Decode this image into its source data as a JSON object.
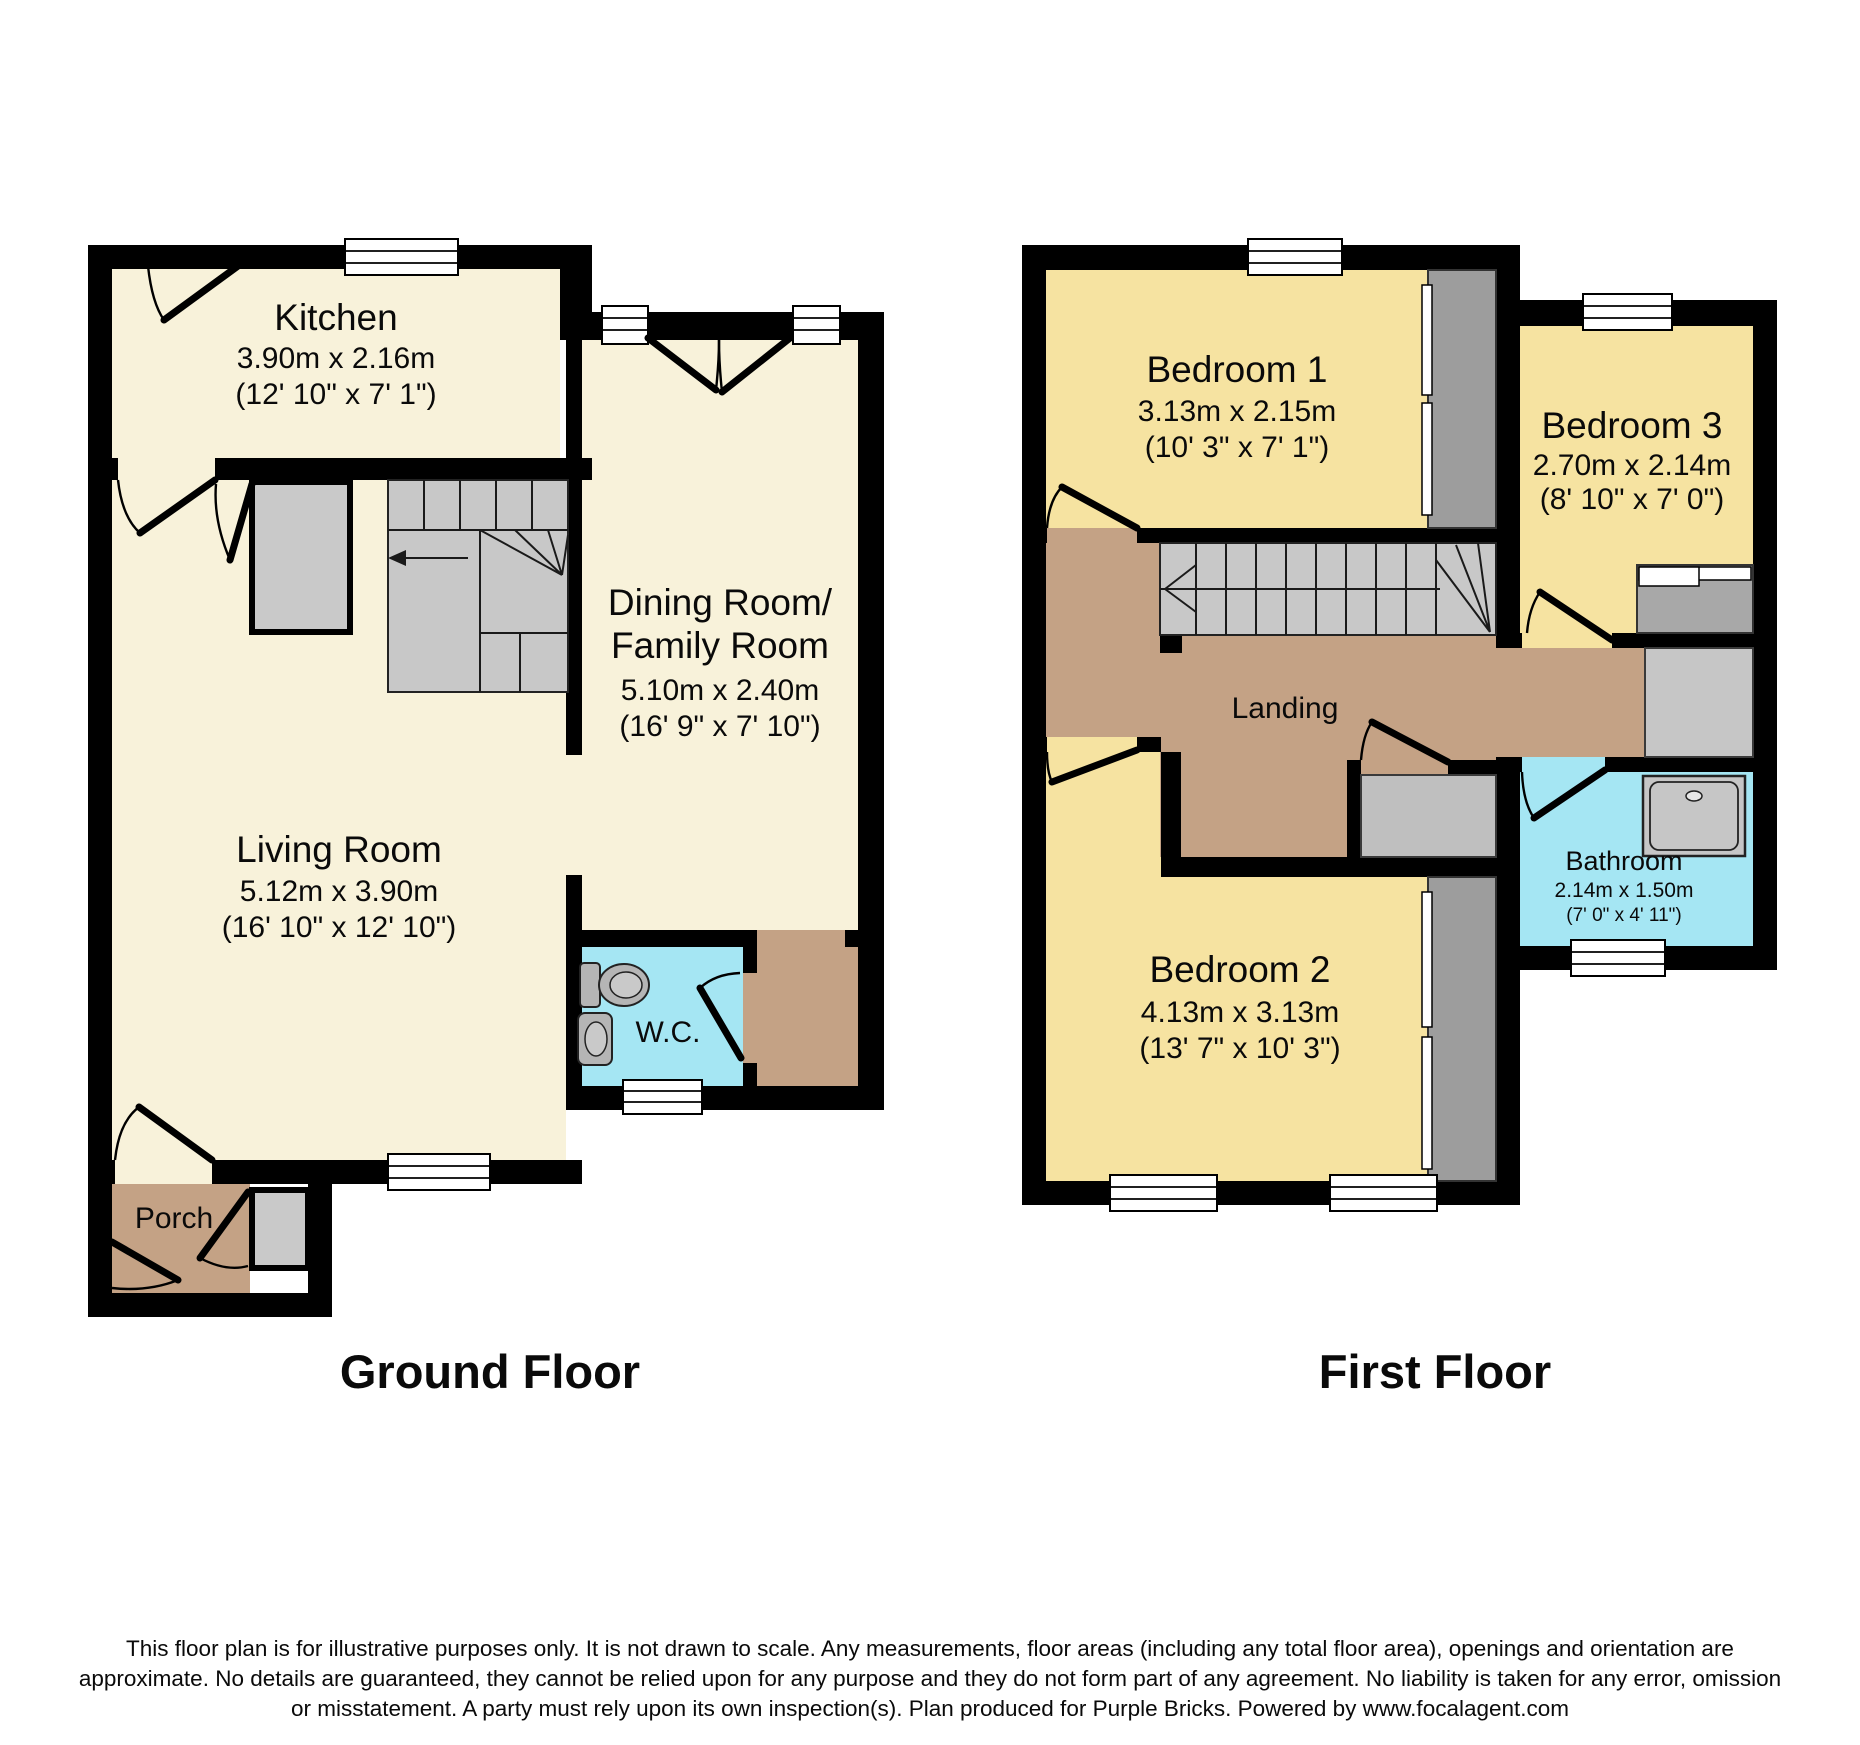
{
  "ground": {
    "title": "Ground Floor",
    "kitchen": {
      "name": "Kitchen",
      "m": "3.90m x 2.16m",
      "ft": "(12' 10\" x 7' 1\")"
    },
    "dining": {
      "name1": "Dining Room/",
      "name2": "Family Room",
      "m": "5.10m x 2.40m",
      "ft": "(16' 9\" x 7' 10\")"
    },
    "living": {
      "name": "Living Room",
      "m": "5.12m x 3.90m",
      "ft": "(16' 10\" x 12' 10\")"
    },
    "wc": {
      "name": "W.C."
    },
    "porch": {
      "name": "Porch"
    }
  },
  "first": {
    "title": "First Floor",
    "bedroom1": {
      "name": "Bedroom 1",
      "m": "3.13m x 2.15m",
      "ft": "(10' 3\" x 7' 1\")"
    },
    "bedroom2": {
      "name": "Bedroom 2",
      "m": "4.13m x 3.13m",
      "ft": "(13' 7\" x 10' 3\")"
    },
    "bedroom3": {
      "name": "Bedroom 3",
      "m": "2.70m x 2.14m",
      "ft": "(8' 10\" x 7' 0\")"
    },
    "landing": {
      "name": "Landing"
    },
    "bathroom": {
      "name": "Bathroom",
      "m": "2.14m x 1.50m",
      "ft": "(7' 0\" x 4' 11\")"
    }
  },
  "footer": {
    "line1": "This floor plan is for illustrative purposes only. It is not drawn to scale. Any measurements, floor areas (including any total floor area), openings and orientation are",
    "line2": "approximate. No details are guaranteed, they cannot be relied upon for any purpose and they do not form part of any agreement. No liability is taken for any error, omission",
    "line3": "or misstatement. A party must rely upon its own inspection(s). Plan produced for Purple Bricks. Powered by www.focalagent.com"
  },
  "colors": {
    "cream": "#F8F2DA",
    "yellow": "#F6E3A1",
    "cyan": "#A5E6F3",
    "brown": "#C4A285",
    "stair_gray": "#C8C8C8",
    "wall": "#000000"
  }
}
